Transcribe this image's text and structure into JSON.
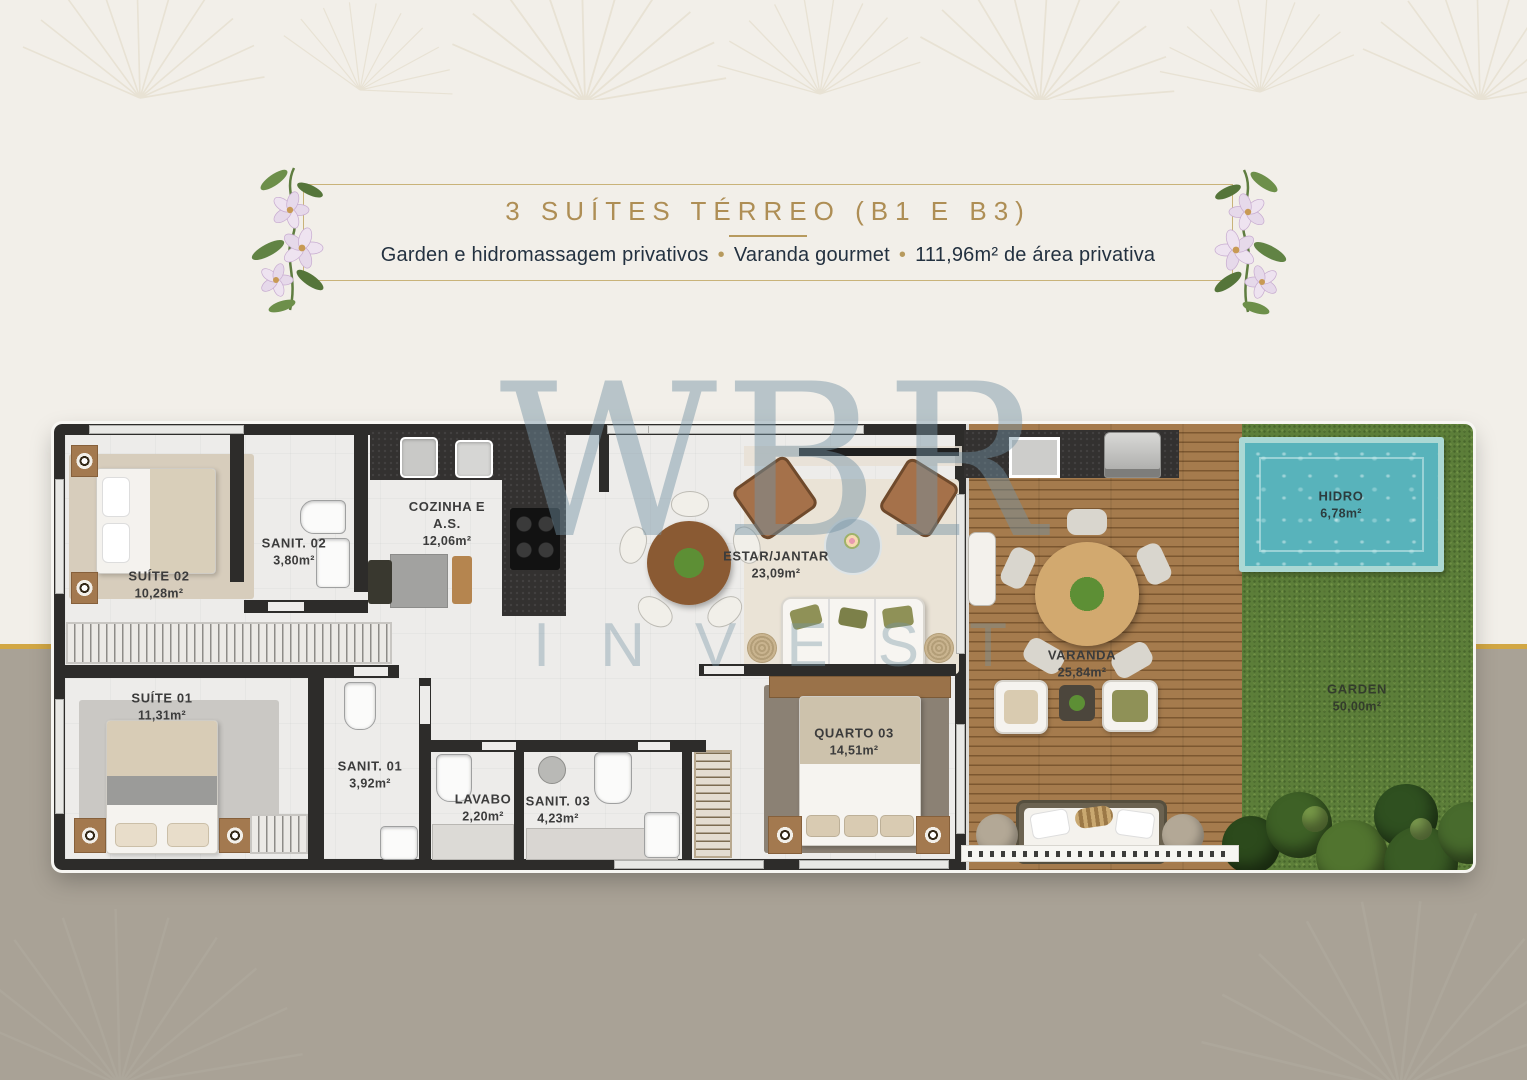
{
  "header": {
    "title": "3 SUÍTES TÉRREO (B1 E B3)",
    "bullet": "•",
    "subtitle_segments": [
      "Garden e hidromassagem privativos",
      "Varanda gourmet",
      "111,96m² de área privativa"
    ]
  },
  "watermark": {
    "line1": "WBR",
    "line2": "INVEST"
  },
  "floorplan": {
    "rooms": [
      {
        "id": "suite-02",
        "name": "SUÍTE 02",
        "area": "10,28m²"
      },
      {
        "id": "sanit-02",
        "name": "SANIT. 02",
        "area": "3,80m²"
      },
      {
        "id": "cozinha-as",
        "name": "COZINHA E A.S.",
        "area": "12,06m²"
      },
      {
        "id": "estar-jantar",
        "name": "ESTAR/JANTAR",
        "area": "23,09m²"
      },
      {
        "id": "suite-01",
        "name": "SUÍTE 01",
        "area": "11,31m²"
      },
      {
        "id": "sanit-01",
        "name": "SANIT. 01",
        "area": "3,92m²"
      },
      {
        "id": "lavabo",
        "name": "LAVABO",
        "area": "2,20m²"
      },
      {
        "id": "sanit-03",
        "name": "SANIT. 03",
        "area": "4,23m²"
      },
      {
        "id": "quarto-03",
        "name": "QUARTO 03",
        "area": "14,51m²"
      },
      {
        "id": "varanda",
        "name": "VARANDA",
        "area": "25,84m²"
      },
      {
        "id": "hidro",
        "name": "HIDRO",
        "area": "6,78m²"
      },
      {
        "id": "garden",
        "name": "GARDEN",
        "area": "50,00m²"
      }
    ]
  },
  "colors": {
    "background_top": "#f2efe9",
    "background_bottom": "#a9a296",
    "gold_rail": "#d2a744",
    "title_gold": "#ae8e55",
    "subtitle_navy": "#233140",
    "wall_dark": "#2d2c2a",
    "deck_wood": "#9b7347",
    "grass_green": "#5c7e39",
    "pool_water": "#58b3bb",
    "watermark_blue": "rgba(116,146,163,0.46)"
  }
}
